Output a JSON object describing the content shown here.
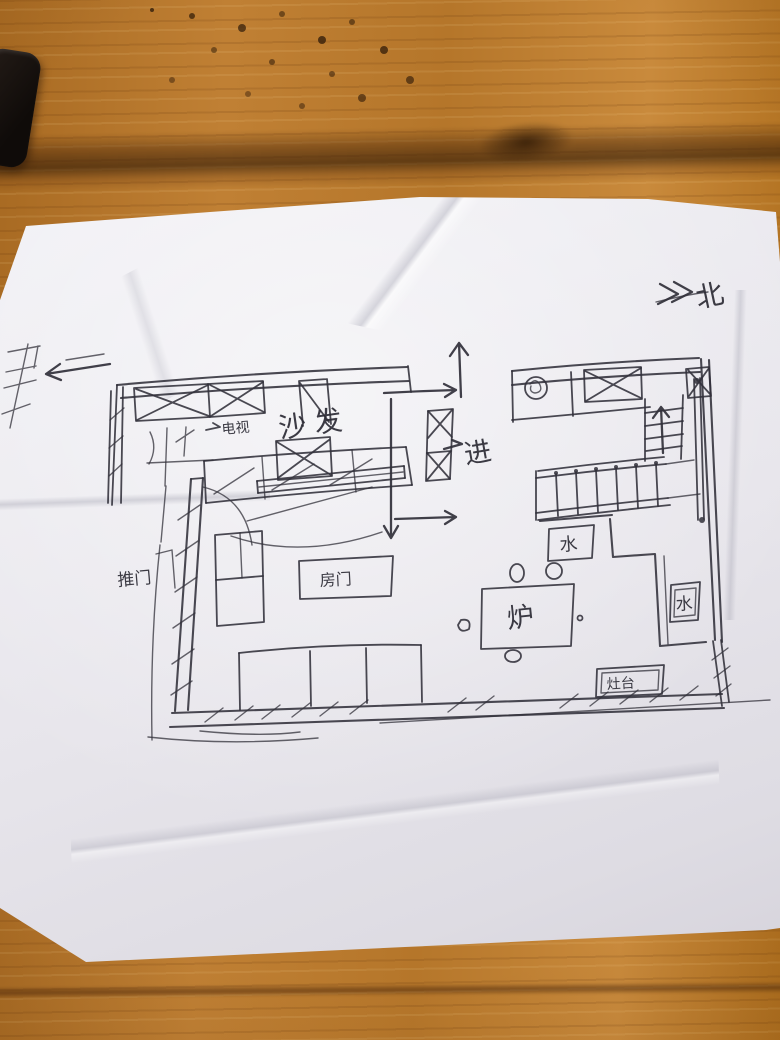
{
  "scene": {
    "paper_color": "#ecebf0",
    "ink_color": "#31303a",
    "wood_color": "#b5762a"
  },
  "plan": {
    "north_label": "北",
    "entry_label": "进",
    "living": {
      "tv_label": "电视",
      "sofa_label": "沙发",
      "room_door_label": "房门",
      "push_door_label": "推门"
    },
    "kitchen": {
      "water_tank_label": "水",
      "water_label": "水",
      "stove_label": "灶台",
      "fire_table_label": "炉"
    }
  }
}
